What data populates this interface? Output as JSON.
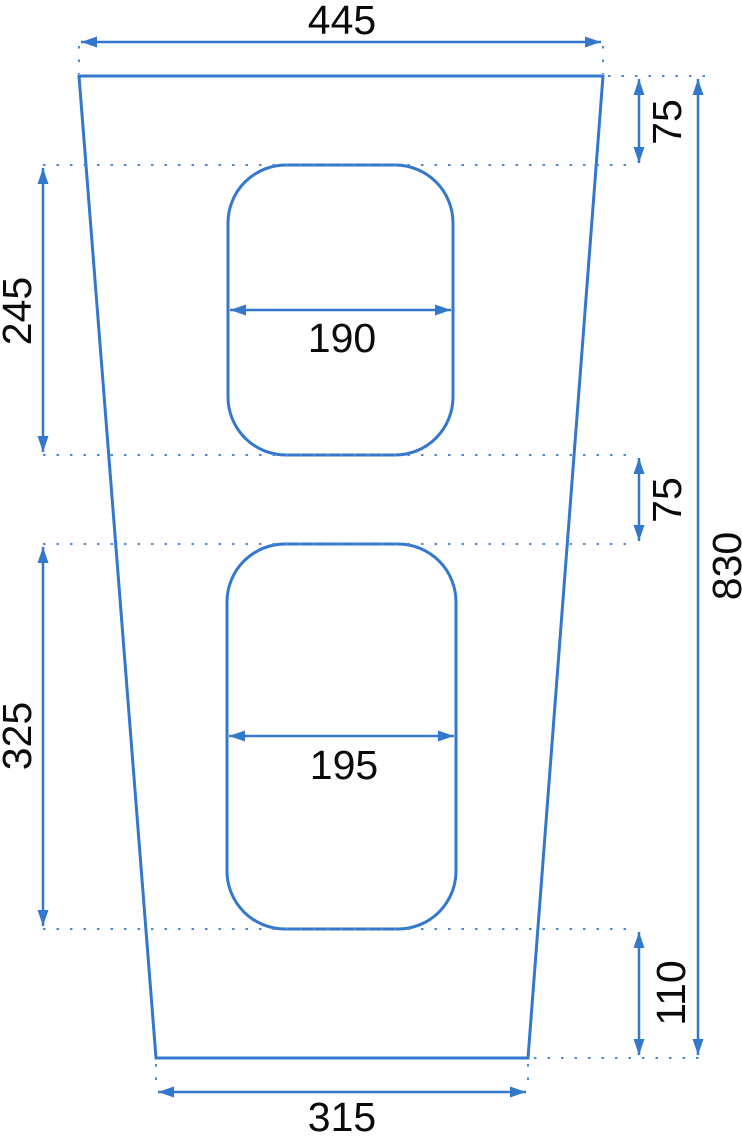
{
  "drawing": {
    "type": "technical-dimension-drawing",
    "subject": "trapezoidal panel with two rounded rectangular cutouts",
    "units_shown": false,
    "accent_color": "#3378cc",
    "extension_line_color": "#4e87d4",
    "label_color": "#0a0a0a",
    "labels": {
      "top_width": "445",
      "top_inset": "75",
      "upper_cutout_height": "245",
      "upper_cutout_width": "190",
      "gap_between_cutouts": "75",
      "lower_cutout_height": "325",
      "lower_cutout_width": "195",
      "bottom_inset": "110",
      "overall_height": "830",
      "bottom_width": "315"
    }
  }
}
